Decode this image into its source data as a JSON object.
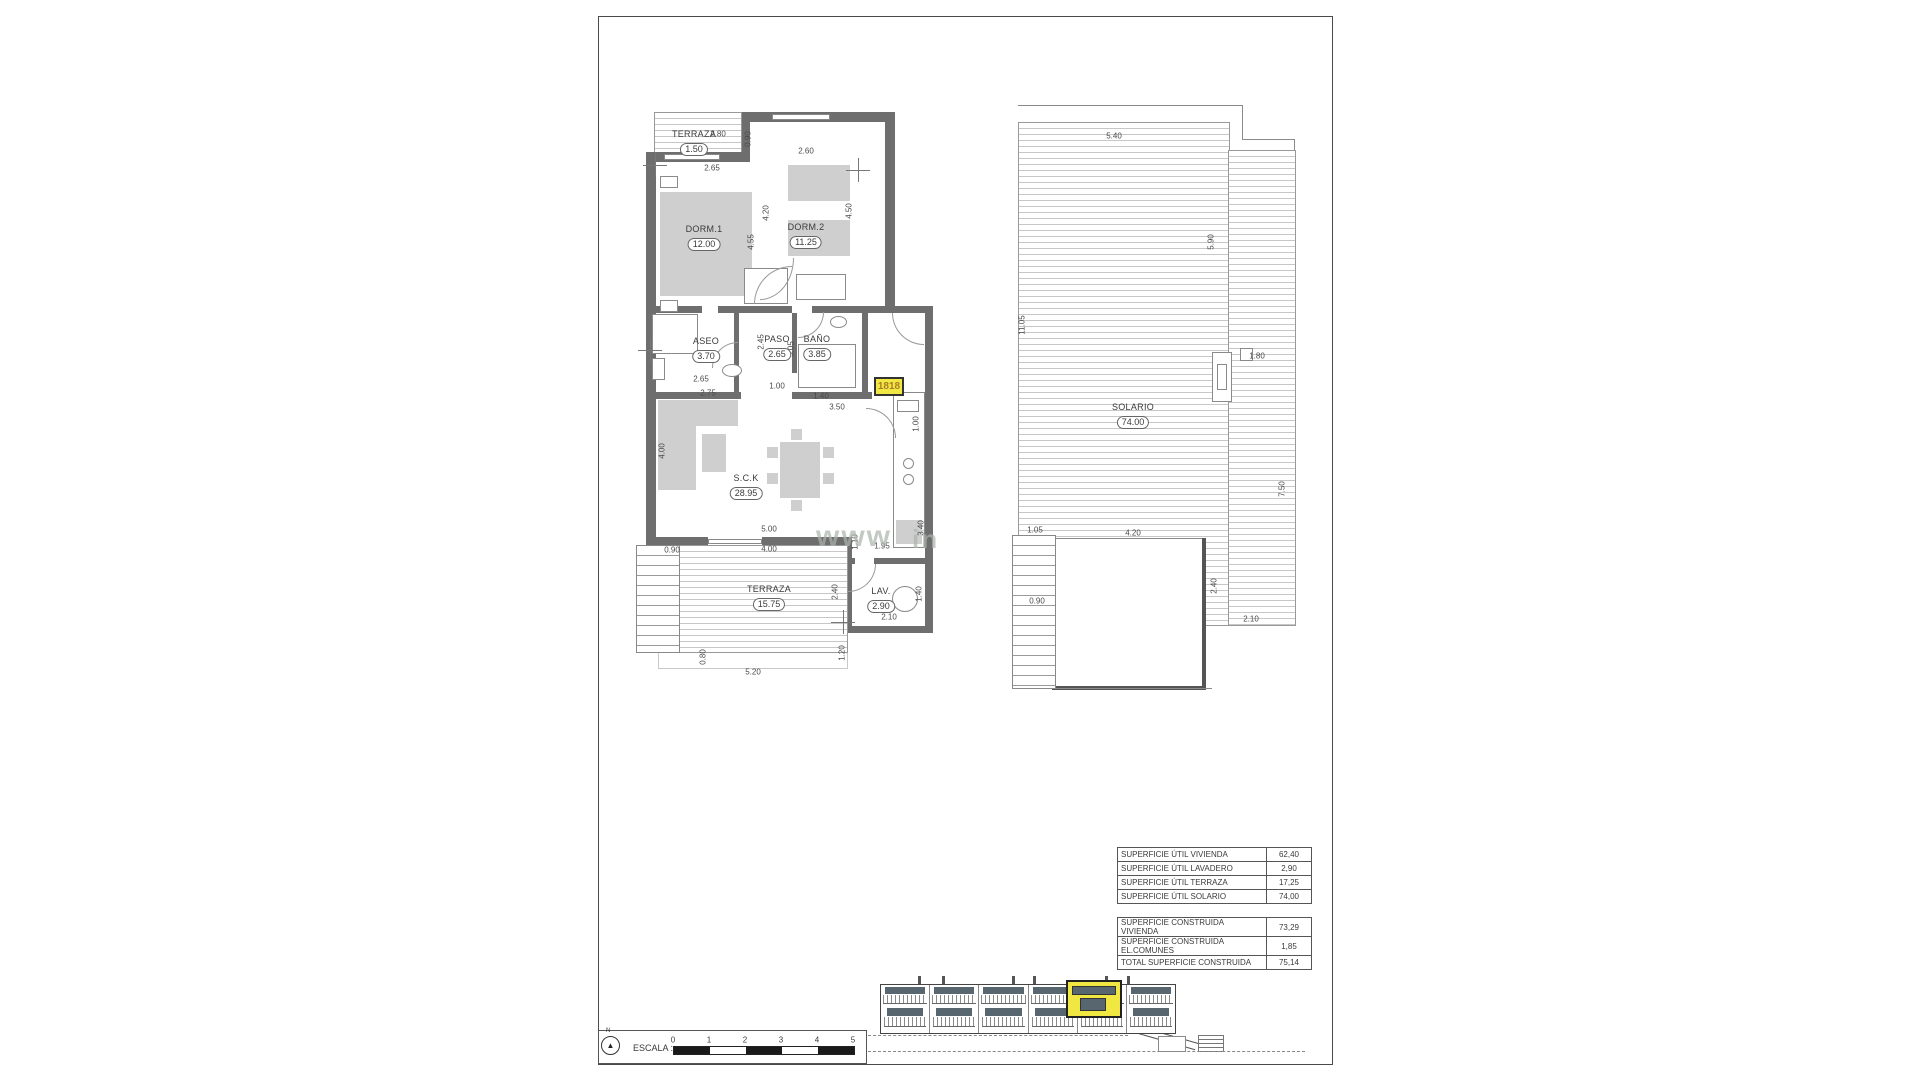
{
  "watermark": {
    "frag1": "www",
    "frag2": "in"
  },
  "floor_plan": {
    "rooms": {
      "terraza_top": {
        "name": "TERRAZA",
        "area": "1.50"
      },
      "dorm1": {
        "name": "DORM.1",
        "area": "12.00"
      },
      "dorm2": {
        "name": "DORM.2",
        "area": "11.25"
      },
      "aseo": {
        "name": "ASEO",
        "area": "3.70"
      },
      "paso": {
        "name": "PASO",
        "area": "2.65"
      },
      "bano": {
        "name": "BAÑO",
        "area": "3.85"
      },
      "sck": {
        "name": "S.C.K",
        "area": "28.95"
      },
      "terraza": {
        "name": "TERRAZA",
        "area": "15.75"
      },
      "lav": {
        "name": "LAV.",
        "area": "2.90"
      }
    },
    "unit_tag": "1818",
    "dims": {
      "terraza_width": "2.80",
      "terraza_depth": "0.90",
      "dorm1_window": "2.65",
      "dorm2_window": "2.60",
      "dorm1_height": "4.55",
      "hall_height": "4.20",
      "dorm2_height": "4.50",
      "paso_left": "2.45",
      "paso_height": "3.05",
      "aseo_width": "2.65",
      "aseo_outer": "2.75",
      "hall_width": "1.00",
      "bano_width": "1.40",
      "entry_width": "3.50",
      "kitchen_top": "1.00",
      "kitchen_height": "3.40",
      "sck_height": "4.00",
      "sck_width": "5.00",
      "terraza_width2": "4.00",
      "step_width": "0.90",
      "passage": "1.10",
      "kitchen_width": "1.95",
      "terraza_height": "2.40",
      "lav_width": "2.10",
      "lav_height": "1.40",
      "terraza_bottom": "5.20",
      "terraza_right": "1.20",
      "stair_width": "0.80"
    }
  },
  "roof_plan": {
    "room": {
      "name": "SOLARIO",
      "area": "74.00"
    },
    "dims": {
      "top": "5.40",
      "right_upper": "5.90",
      "left": "11.05",
      "vent": "1.80",
      "stair_top": "1.05",
      "court_width": "4.20",
      "right_lower": "7.50",
      "court_height": "2.40",
      "court_step": "2.10",
      "stair_width": "0.90"
    }
  },
  "tables": {
    "util": [
      {
        "label": "SUPERFICIE ÚTIL VIVIENDA",
        "value": "62,40"
      },
      {
        "label": "SUPERFICIE ÚTIL LAVADERO",
        "value": "2,90"
      },
      {
        "label": "SUPERFICIE ÚTIL TERRAZA",
        "value": "17,25"
      },
      {
        "label": "SUPERFICIE ÚTIL SOLARIO",
        "value": "74,00"
      }
    ],
    "construida": [
      {
        "label": "SUPERFICIE CONSTRUIDA VIVIENDA",
        "value": "73,29"
      },
      {
        "label": "SUPERFICIE CONSTRUIDA EL.COMUNES",
        "value": "1,85"
      },
      {
        "label": "TOTAL SUPERFICIE CONSTRUIDA",
        "value": "75,14"
      }
    ]
  },
  "scale_bar": {
    "north": "N",
    "label": "ESCALA :",
    "ticks": [
      "0",
      "1",
      "2",
      "3",
      "4",
      "5"
    ]
  },
  "icons": {
    "north_arrow": "▲"
  },
  "colors": {
    "highlight": "#f1e743",
    "wall": "#6e6e6e",
    "glazing": "#57666f"
  }
}
